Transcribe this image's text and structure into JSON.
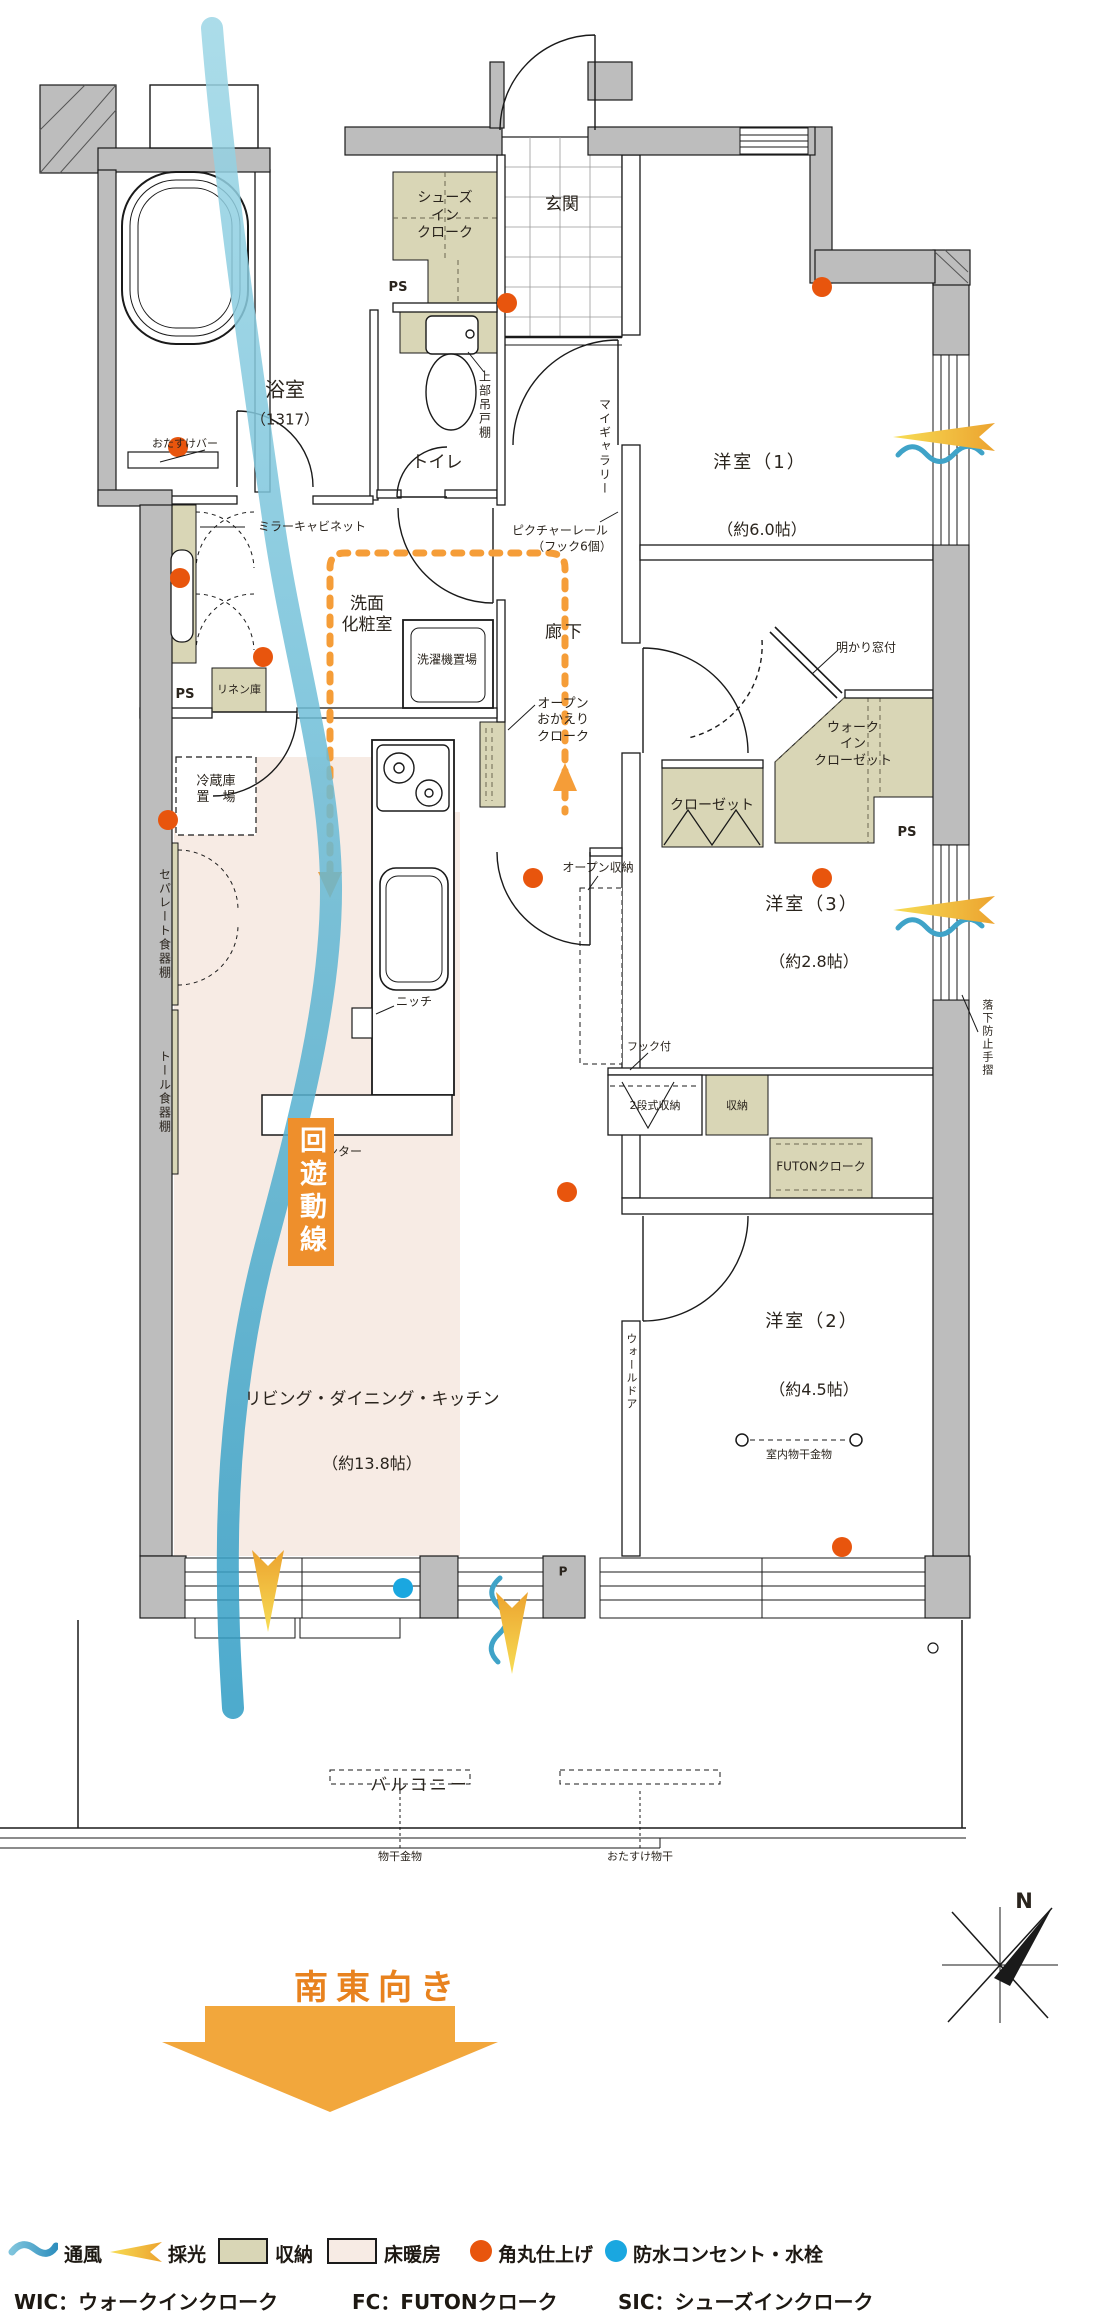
{
  "labels": {
    "genkan": "玄関",
    "sic": {
      "l1": "シューズ",
      "l2": "イン",
      "l3": "クローク"
    },
    "ps": "PS",
    "pillar": "P",
    "bath": "浴室",
    "bath_size": "（1317）",
    "grab_bar": "おたすけバー",
    "toilet": "トイレ",
    "upper_cabinet": "上部吊戸棚",
    "my_gallery": "マイギャラリー",
    "room1": "洋室（1）",
    "room1_size": "（約6.0帖）",
    "mirror_cabinet": "ミラーキャビネット",
    "powder": {
      "l1": "洗面",
      "l2": "化粧室"
    },
    "washer": "洗濯機置場",
    "hallway": "廊下",
    "picture_rail": "ピクチャーレール",
    "picture_rail_sub": "（フック6個）",
    "okaeri": {
      "l1": "オープン",
      "l2": "おかえり",
      "l3": "クローク"
    },
    "linen": "リネン庫",
    "fridge": {
      "l1": "冷蔵庫",
      "l2": "置　場"
    },
    "cupboard_separate": "セパレート食器棚",
    "cupboard_tall": "トール食器棚",
    "open_storage": "オープン収納",
    "niche": "ニッチ",
    "counter": "カウンター",
    "circulation": "回遊動線",
    "closet": "クローゼット",
    "wic": {
      "l1": "ウォーク",
      "l2": "イン",
      "l3": "クローゼット"
    },
    "light_window": "明かり窓付",
    "room3": "洋室（3）",
    "room3_size": "（約2.8帖）",
    "fall_prevention": "落下防止手摺",
    "hook": "フック付",
    "two_tier_storage": "2段式収納",
    "storage": "収納",
    "futon_cloak": "FUTONクローク",
    "room2": "洋室（2）",
    "room2_size": "（約4.5帖）",
    "wall_door": "ウォールドア",
    "indoor_drying": "室内物干金物",
    "ldk": "リビング・ダイニング・キッチン",
    "ldk_size": "（約13.8帖）",
    "balcony": "バルコニー",
    "drying_fixture": "物干金物",
    "otasuke_drying": "おたすけ物干",
    "direction": "南東向き",
    "north": "N"
  },
  "legend": {
    "items": [
      {
        "icon": "wind-wave-icon",
        "label": "通風"
      },
      {
        "icon": "daylight-arrow-icon",
        "label": "採光"
      },
      {
        "icon": "storage-swatch",
        "label": "収納"
      },
      {
        "icon": "floor-heating-swatch",
        "label": "床暖房"
      },
      {
        "icon": "rounded-corner-dot",
        "label": "角丸仕上げ"
      },
      {
        "icon": "waterproof-outlet-dot",
        "label": "防水コンセント・水栓"
      }
    ],
    "abbreviations": [
      "WIC：ウォークインクローク",
      "FC：FUTONクローク",
      "SIC：シューズインクローク"
    ]
  },
  "colors": {
    "wall_gray": "#bdbdbd",
    "storage_beige": "#d9d6b6",
    "floor_heating_pink": "#f7ebe4",
    "accent_orange": "#e8550d",
    "route_orange": "#f59d38",
    "daylight_yellow": "#f2c23c",
    "wind_blue": "#3fa3c8",
    "waterproof_blue": "#1aa7e0"
  }
}
